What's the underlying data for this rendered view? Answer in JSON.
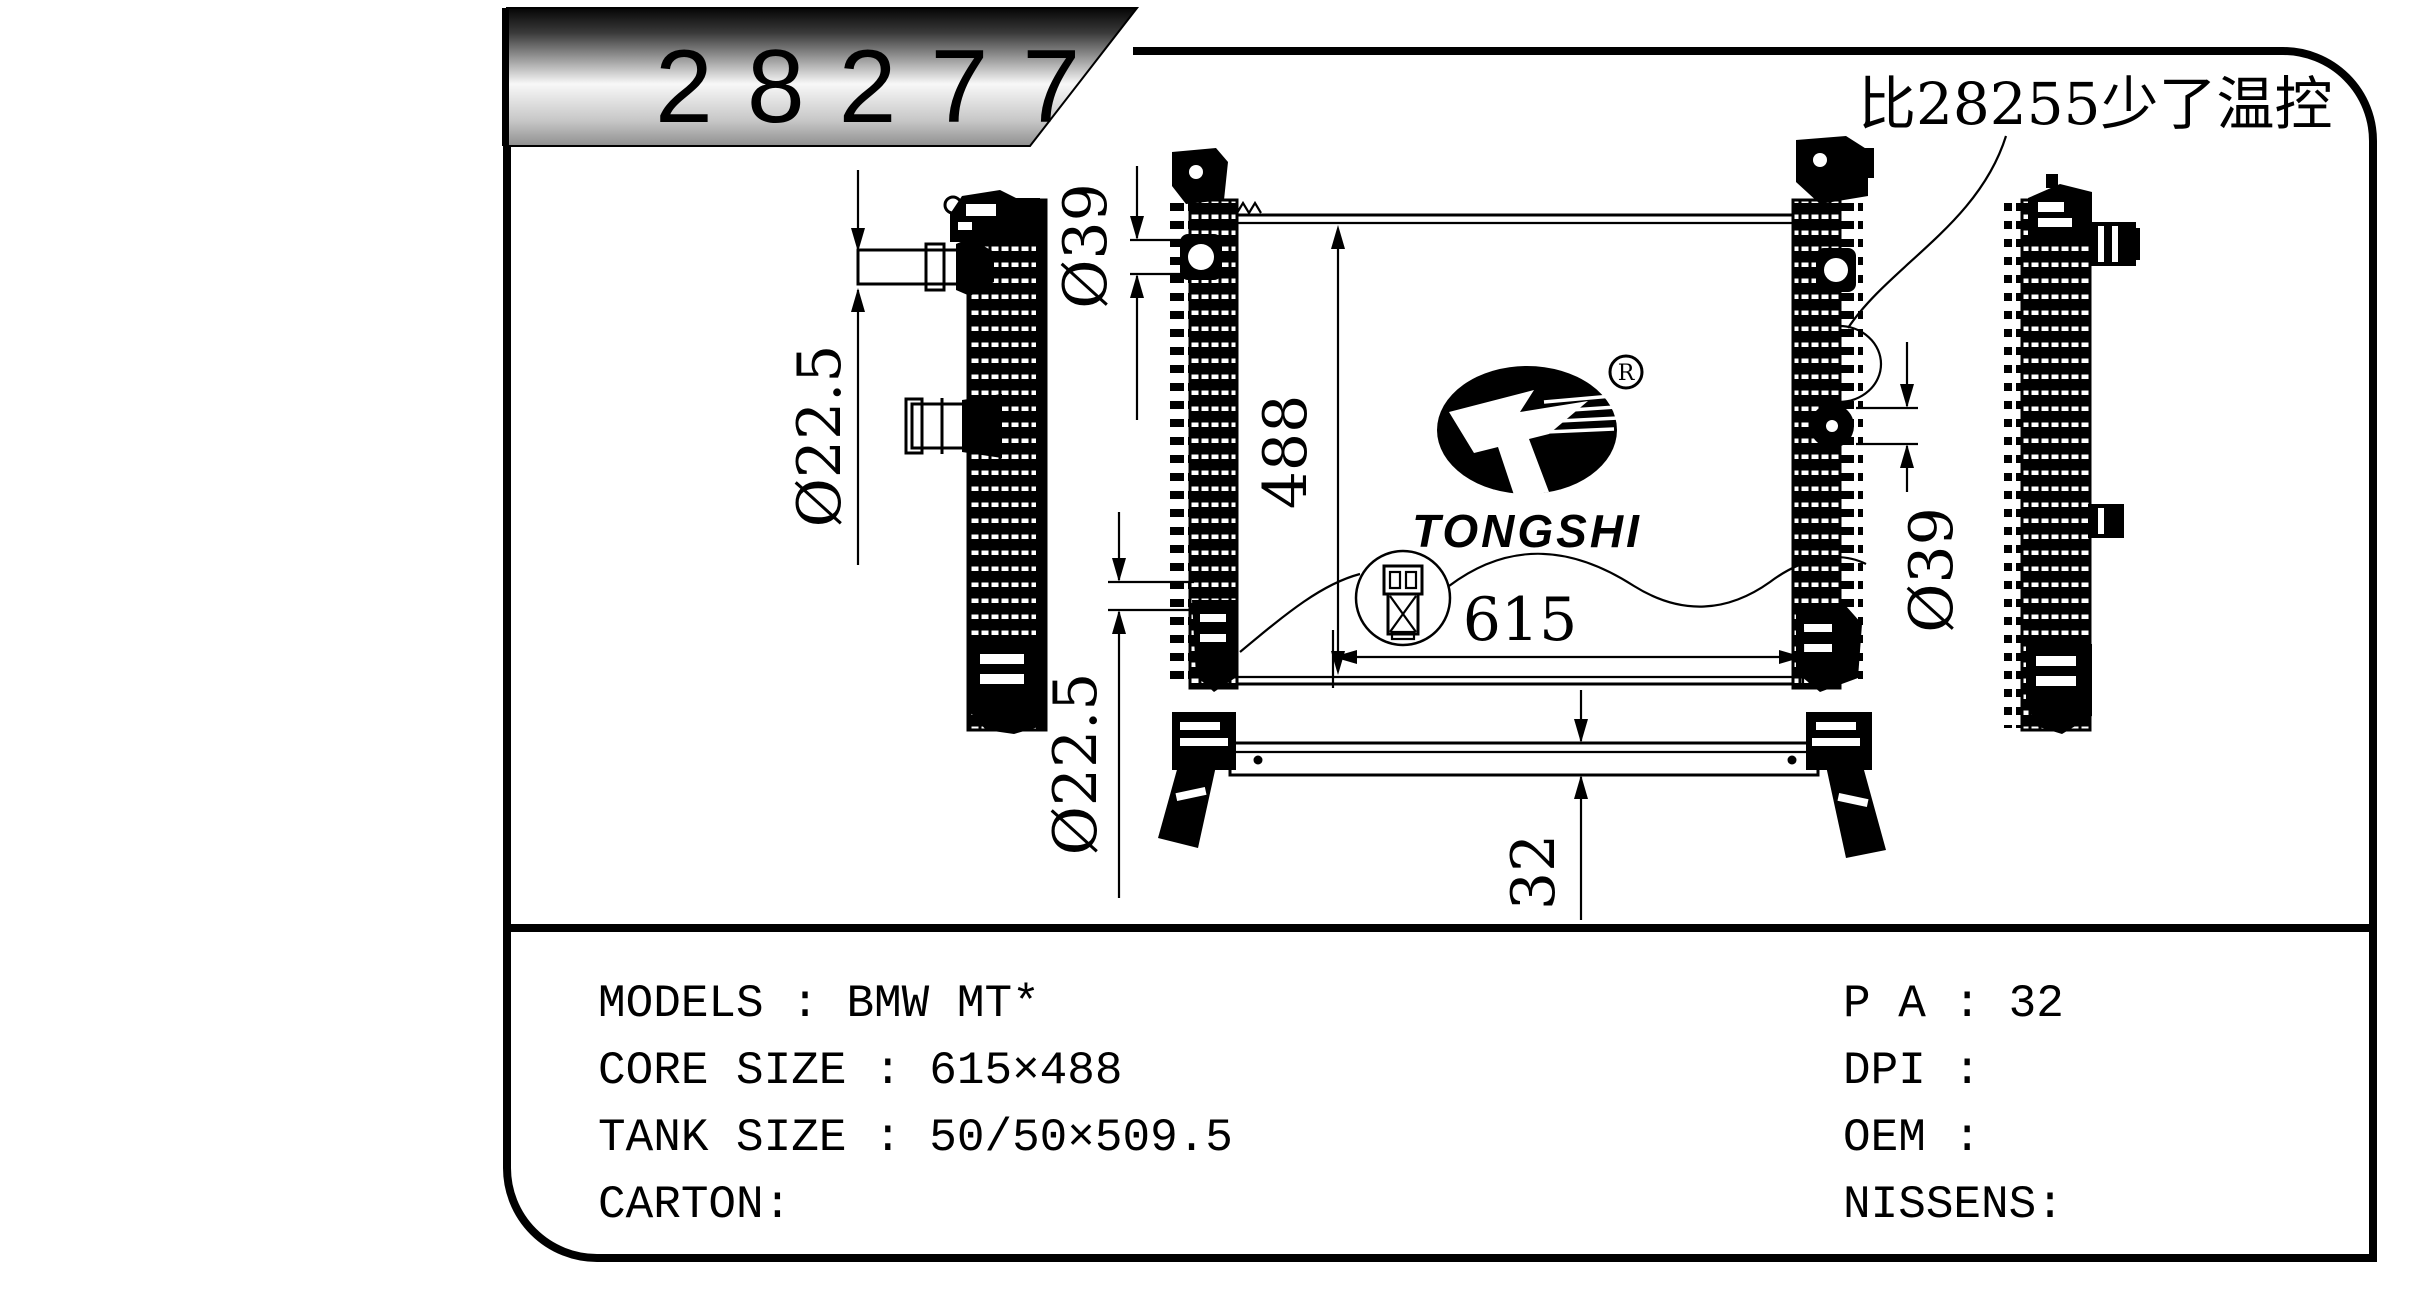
{
  "banner": {
    "part_number": "28277"
  },
  "note": {
    "text": "比28255少了温控"
  },
  "logo": {
    "brand": "TONGSHI",
    "registered_mark": "R"
  },
  "dimensions": {
    "core_height": "488",
    "core_width": "615",
    "inlet_pipe": "Ø22.5",
    "inlet_port": "Ø39",
    "outlet_port": "Ø39",
    "outlet_pipe": "Ø22.5",
    "crossmember_height": "32"
  },
  "specs": {
    "left_rows": [
      "MODELS : BMW MT*",
      "CORE SIZE : 615×488",
      "TANK SIZE : 50/50×509.5",
      "CARTON:"
    ],
    "right_rows": [
      "P A : 32",
      "DPI :",
      "OEM :",
      "NISSENS:"
    ]
  },
  "colors": {
    "ink": "#000000",
    "paper": "#ffffff",
    "banner_gradient_top": "#050505",
    "banner_gradient_mid": "#f8f8f8",
    "banner_gradient_bottom": "#8f8f8f"
  }
}
